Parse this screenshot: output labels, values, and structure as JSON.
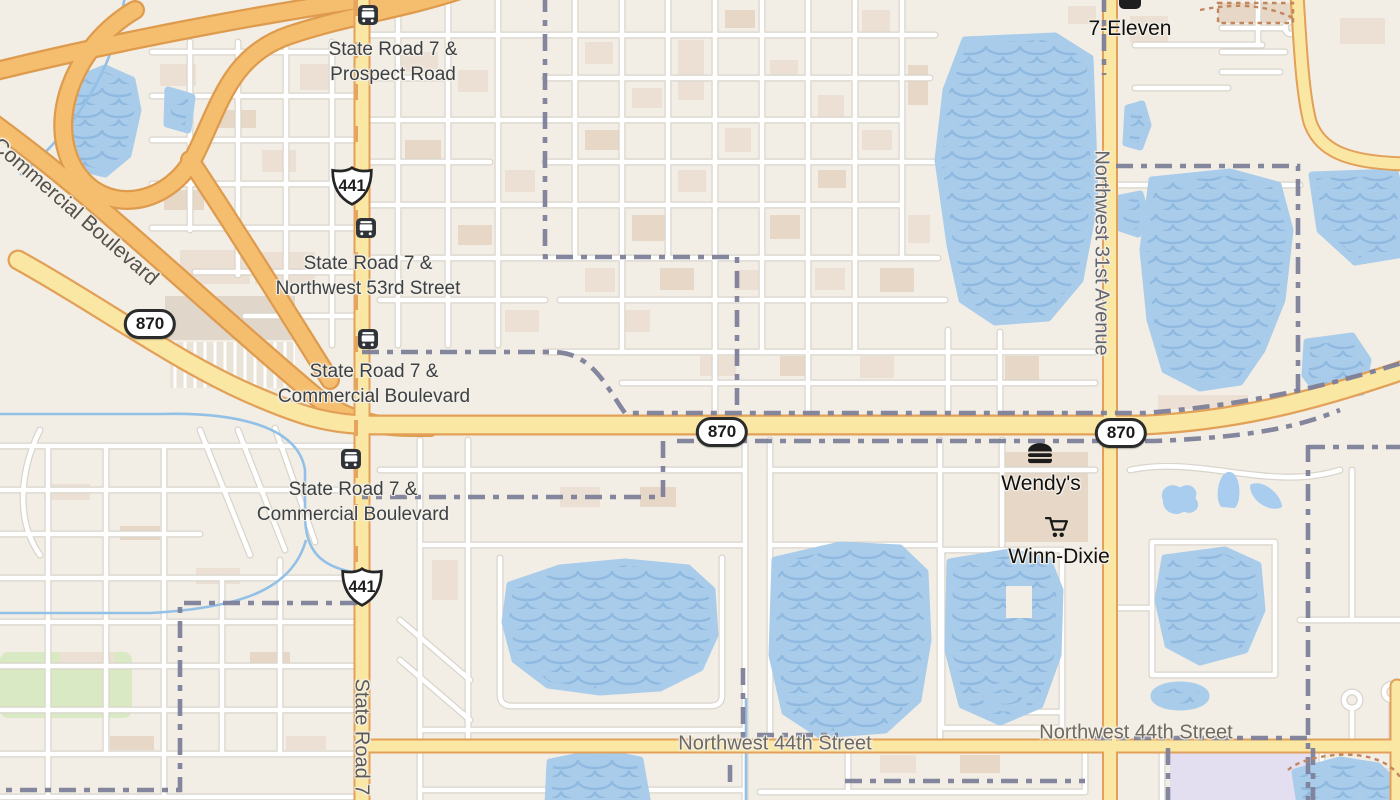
{
  "shields": {
    "us_441": "441",
    "fl_870": "870"
  },
  "transit_stops": [
    {
      "line1": "State Road 7 &",
      "line2": "Prospect Road"
    },
    {
      "line1": "State Road 7 &",
      "line2": "Northwest 53rd Street"
    },
    {
      "line1": "State Road 7 &",
      "line2": "Commercial Boulevard"
    },
    {
      "line1": "State Road 7 &",
      "line2": "Commercial Boulevard"
    }
  ],
  "pois": [
    {
      "name": "7-Eleven",
      "icon": "convenience-store-icon"
    },
    {
      "name": "Wendy's",
      "icon": "burger-icon"
    },
    {
      "name": "Winn-Dixie",
      "icon": "shopping-cart-icon"
    }
  ],
  "streets": {
    "commercial_blvd": "Commercial Boulevard",
    "state_road": "State Road 7",
    "nw_31st": "Northwest 31st Avenue",
    "nw_44th_west": "Northwest 44th Street",
    "nw_44th_east": "Northwest 44th Street"
  },
  "colors": {
    "background": "#F2EEE5",
    "water": "#A9CCEB",
    "water_wave": "#8FB9DF",
    "major_road": "#FAE7A3",
    "major_road_casing": "#E2A058",
    "freeway": "#F5BE6E",
    "freeway_casing": "#DE9B4E",
    "minor_road": "#FFFFFF",
    "minor_road_casing": "#D9D4CA",
    "boundary": "#7D8099",
    "park": "#D9E9C4",
    "school_area": "#E4DFF0",
    "building": "#ECE0D4",
    "trail": "#C2865D",
    "transit_label": "#3C4146",
    "street_label": "#6E6A60",
    "poi_label": "#101010"
  }
}
